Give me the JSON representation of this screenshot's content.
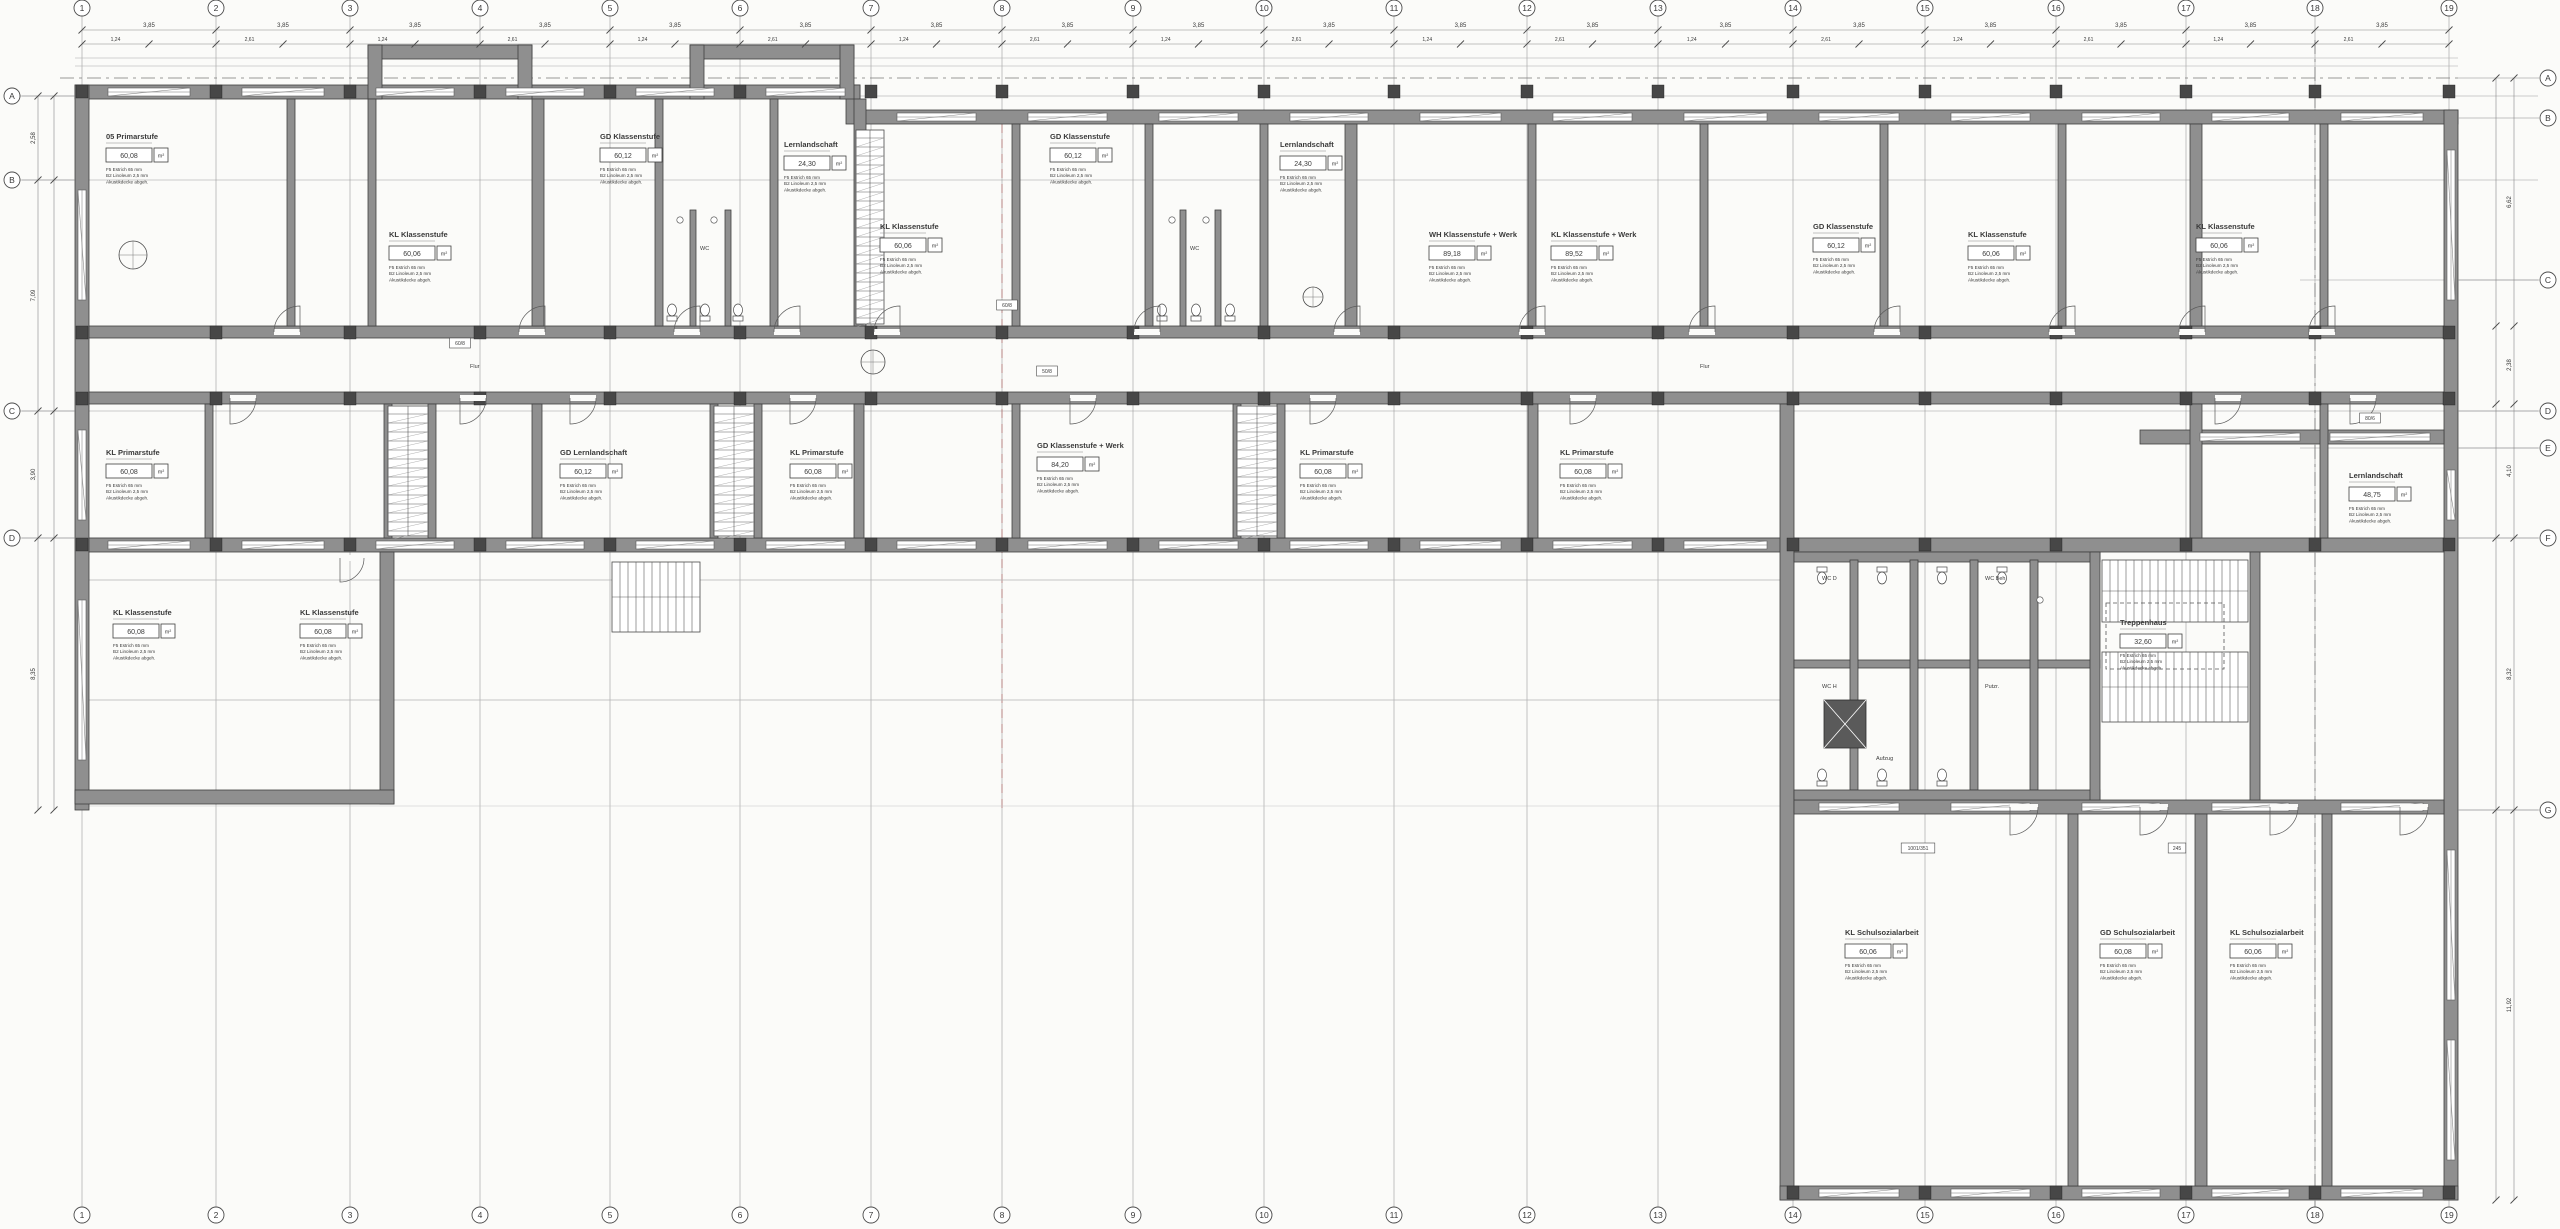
{
  "canvas": {
    "background": "#fbfbf9",
    "line_color": "#4a4a4a",
    "grid_line_color": "#9b9b9b",
    "wall_fill": "#8f8f8f",
    "wall_dark": "#474747",
    "accent_red": "#b25c5c",
    "dim_text_color": "#555555"
  },
  "grid": {
    "columns": [
      {
        "label": "1",
        "x": 82
      },
      {
        "label": "2",
        "x": 216
      },
      {
        "label": "3",
        "x": 350
      },
      {
        "label": "4",
        "x": 480
      },
      {
        "label": "5",
        "x": 610
      },
      {
        "label": "6",
        "x": 740
      },
      {
        "label": "7",
        "x": 871
      },
      {
        "label": "8",
        "x": 1002
      },
      {
        "label": "9",
        "x": 1133
      },
      {
        "label": "10",
        "x": 1264
      },
      {
        "label": "11",
        "x": 1394
      },
      {
        "label": "12",
        "x": 1527
      },
      {
        "label": "13",
        "x": 1658
      },
      {
        "label": "14",
        "x": 1793
      },
      {
        "label": "15",
        "x": 1925
      },
      {
        "label": "16",
        "x": 2056
      },
      {
        "label": "17",
        "x": 2186
      },
      {
        "label": "18",
        "x": 2315
      },
      {
        "label": "19",
        "x": 2449
      }
    ],
    "rows_left": [
      {
        "label": "A",
        "y": 96
      },
      {
        "label": "B",
        "y": 180
      },
      {
        "label": "C",
        "y": 411
      },
      {
        "label": "D",
        "y": 538
      }
    ],
    "rows_right": [
      {
        "label": "A",
        "y": 78
      },
      {
        "label": "B",
        "y": 118
      },
      {
        "label": "C",
        "y": 280
      },
      {
        "label": "D",
        "y": 411
      },
      {
        "label": "E",
        "y": 448
      },
      {
        "label": "F",
        "y": 538
      },
      {
        "label": "G",
        "y": 810
      }
    ]
  },
  "dimensions": {
    "top_bay": "3,85",
    "top_inner": [
      "1,24",
      "2,61"
    ],
    "left_chain": [
      "2,58",
      "7,09",
      "3,90",
      "8,35"
    ],
    "right_chain": [
      "6,62",
      "2,38",
      "4,10",
      "8,32",
      "11,92"
    ]
  },
  "area_unit": "m²",
  "room_notes": [
    "F5 Estrich 65 mm",
    "B2 Linoleum 2,5 mm",
    "Akustikdecke abgeh."
  ],
  "rooms": [
    {
      "title": "05 Primarstufe",
      "area": "60,08",
      "x": 106,
      "y": 139
    },
    {
      "title": "KL Klassenstufe",
      "area": "60,06",
      "x": 389,
      "y": 237
    },
    {
      "title": "GD Klassenstufe",
      "area": "60,12",
      "x": 600,
      "y": 139
    },
    {
      "title": "Lernlandschaft",
      "area": "24,30",
      "x": 784,
      "y": 147
    },
    {
      "title": "KL Klassenstufe",
      "area": "60,06",
      "x": 880,
      "y": 229
    },
    {
      "title": "GD Klassenstufe",
      "area": "60,12",
      "x": 1050,
      "y": 139
    },
    {
      "title": "Lernlandschaft",
      "area": "24,30",
      "x": 1280,
      "y": 147
    },
    {
      "title": "WH Klassenstufe + Werk",
      "area": "89,18",
      "x": 1429,
      "y": 237
    },
    {
      "title": "KL Klassenstufe + Werk",
      "area": "89,52",
      "x": 1551,
      "y": 237
    },
    {
      "title": "GD Klassenstufe",
      "area": "60,12",
      "x": 1813,
      "y": 229
    },
    {
      "title": "KL Klassenstufe",
      "area": "60,06",
      "x": 1968,
      "y": 237
    },
    {
      "title": "KL Klassenstufe",
      "area": "60,06",
      "x": 2196,
      "y": 229
    },
    {
      "title": "KL Primarstufe",
      "area": "60,08",
      "x": 106,
      "y": 455
    },
    {
      "title": "GD Lernlandschaft",
      "area": "60,12",
      "x": 560,
      "y": 455
    },
    {
      "title": "KL Primarstufe",
      "area": "60,08",
      "x": 790,
      "y": 455
    },
    {
      "title": "GD Klassenstufe + Werk",
      "area": "84,20",
      "x": 1037,
      "y": 448
    },
    {
      "title": "KL Primarstufe",
      "area": "60,08",
      "x": 1300,
      "y": 455
    },
    {
      "title": "KL Primarstufe",
      "area": "60,08",
      "x": 1560,
      "y": 455
    },
    {
      "title": "Lernlandschaft",
      "area": "48,75",
      "x": 2349,
      "y": 478
    },
    {
      "title": "KL Klassenstufe",
      "area": "60,08",
      "x": 113,
      "y": 615
    },
    {
      "title": "KL Klassenstufe",
      "area": "60,08",
      "x": 300,
      "y": 615
    },
    {
      "title": "KL Schulsozialarbeit",
      "area": "60,06",
      "x": 1845,
      "y": 935
    },
    {
      "title": "GD Schulsozialarbeit",
      "area": "60,08",
      "x": 2100,
      "y": 935
    },
    {
      "title": "KL Schulsozialarbeit",
      "area": "60,06",
      "x": 2230,
      "y": 935
    },
    {
      "title": "Treppenhaus",
      "area": "32,60",
      "x": 2120,
      "y": 625,
      "dashed": true
    }
  ],
  "small_labels": [
    {
      "text": "WC",
      "x": 700,
      "y": 250
    },
    {
      "text": "WC",
      "x": 1190,
      "y": 250
    },
    {
      "text": "WC D",
      "x": 1822,
      "y": 580
    },
    {
      "text": "WC H",
      "x": 1822,
      "y": 688
    },
    {
      "text": "WC Beh.",
      "x": 1985,
      "y": 580
    },
    {
      "text": "Putzr.",
      "x": 1985,
      "y": 688
    },
    {
      "text": "Aufzug",
      "x": 1876,
      "y": 760
    },
    {
      "text": "Flur",
      "x": 470,
      "y": 368
    },
    {
      "text": "Flur",
      "x": 1700,
      "y": 368
    }
  ],
  "wall_tags": [
    {
      "text": "60/8",
      "x": 1007,
      "y": 307
    },
    {
      "text": "50/8",
      "x": 1047,
      "y": 373
    },
    {
      "text": "1001/351",
      "x": 1918,
      "y": 850
    },
    {
      "text": "245",
      "x": 2177,
      "y": 850
    },
    {
      "text": "80/6",
      "x": 2370,
      "y": 420
    },
    {
      "text": "60/8",
      "x": 460,
      "y": 345
    }
  ]
}
